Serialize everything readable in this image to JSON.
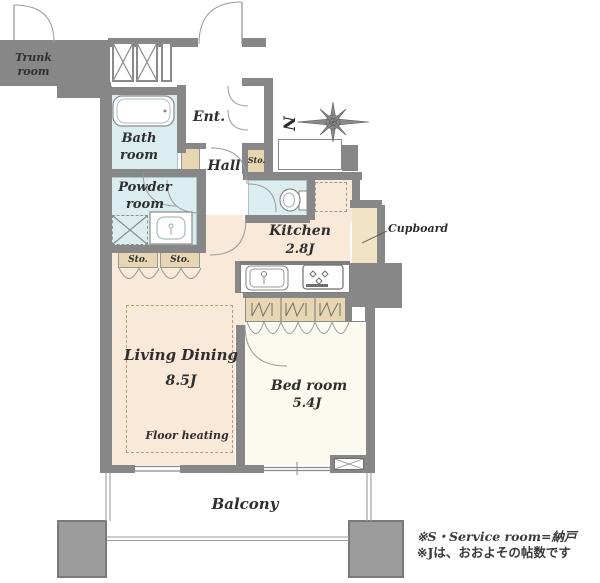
{
  "rooms": {
    "trunk": {
      "label": "Trunk room"
    },
    "bath": {
      "label": "Bath room"
    },
    "powder": {
      "label": "Powder room"
    },
    "entrance": {
      "label": "Ent."
    },
    "hall": {
      "label": "Hall"
    },
    "kitchen": {
      "label": "Kitchen",
      "size": "2.8J"
    },
    "living_dining": {
      "label": "Living Dining",
      "size": "8.5J",
      "floor_note": "Floor heating"
    },
    "bedroom": {
      "label": "Bed room",
      "size": "5.4J"
    },
    "balcony": {
      "label": "Balcony"
    }
  },
  "fixtures": {
    "storage_abbrev": "Sto.",
    "cupboard": "Cupboard"
  },
  "compass": {
    "letter": "N"
  },
  "footnotes": {
    "service_room": "※S・Service room=納戸",
    "jo_note": "※Jは、おおよその帖数です"
  },
  "colors": {
    "wall": "#878787",
    "floor_main": "#f9e9d9",
    "floor_bedroom": "#fafaee",
    "floor_wet": "#dcedf0",
    "storage": "#e8d6b2"
  }
}
